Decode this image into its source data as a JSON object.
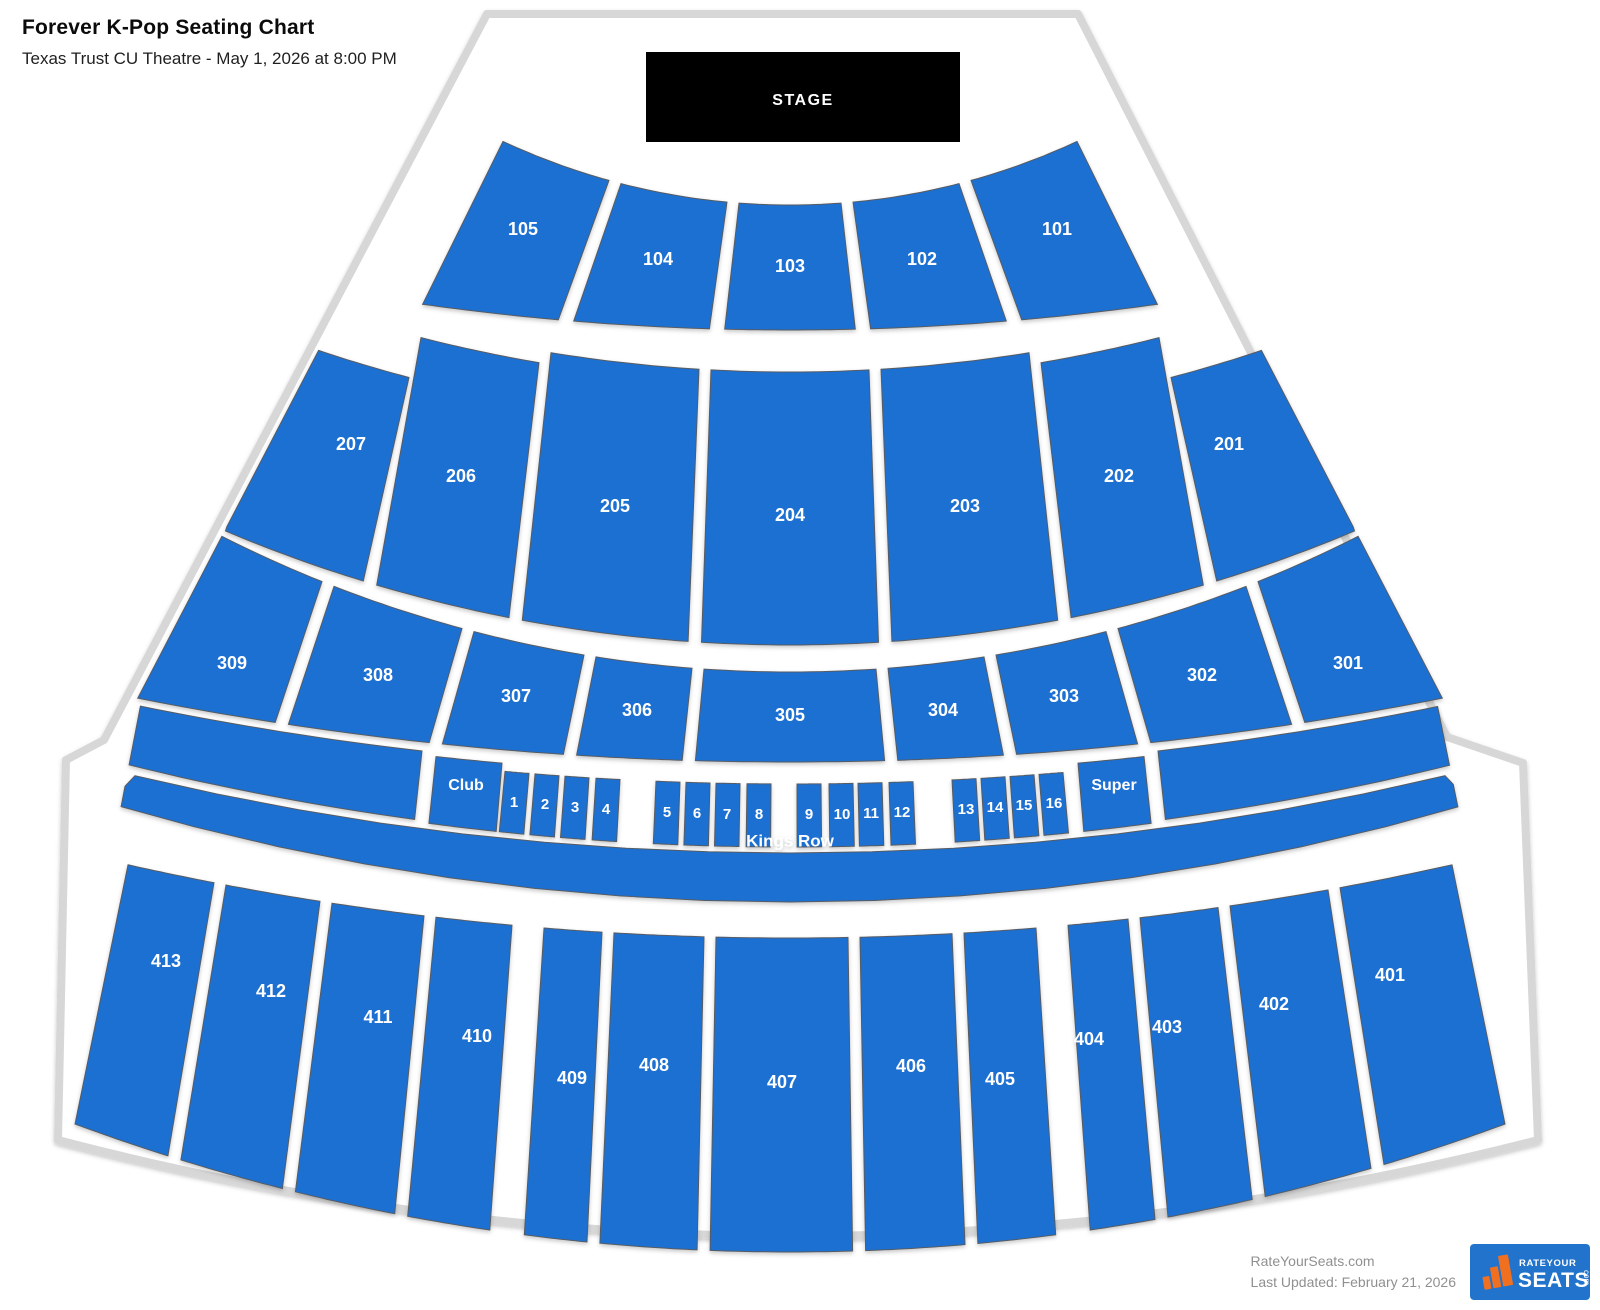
{
  "header": {
    "title": "Forever K-Pop Seating Chart",
    "subtitle": "Texas Trust CU Theatre - May 1, 2026 at 8:00 PM"
  },
  "stage": {
    "label": "STAGE"
  },
  "sections": {
    "level_100": [
      "105",
      "104",
      "103",
      "102",
      "101"
    ],
    "level_200": [
      "207",
      "206",
      "205",
      "204",
      "203",
      "202",
      "201"
    ],
    "level_300": [
      "309",
      "308",
      "307",
      "306",
      "305",
      "304",
      "303",
      "302",
      "301"
    ],
    "boxes": {
      "club_label": "Club",
      "numbers": [
        "1",
        "2",
        "3",
        "4",
        "5",
        "6",
        "7",
        "8",
        "9",
        "10",
        "11",
        "12",
        "13",
        "14",
        "15",
        "16"
      ],
      "super_label": "Super"
    },
    "kings_row_label": "Kings Row",
    "level_400": [
      "413",
      "412",
      "411",
      "410",
      "409",
      "408",
      "407",
      "406",
      "405",
      "404",
      "403",
      "402",
      "401"
    ]
  },
  "footer": {
    "site": "RateYourSeats.com",
    "last_updated": "Last Updated: February 21, 2026",
    "logo": {
      "line1": "RATEYOUR",
      "line2": "SEATS",
      "suffix": "com"
    }
  },
  "colors": {
    "section_fill": "#1e6fd1",
    "section_stroke": "#565c63",
    "stage_bg": "#000000",
    "stage_text": "#ffffff",
    "label_text": "#ffffff",
    "outline_stroke": "#d7d7d7",
    "venue_fill": "#ffffff",
    "logo_bg": "#2173cb",
    "logo_orange": "#f07020",
    "footer_text": "#909090"
  }
}
